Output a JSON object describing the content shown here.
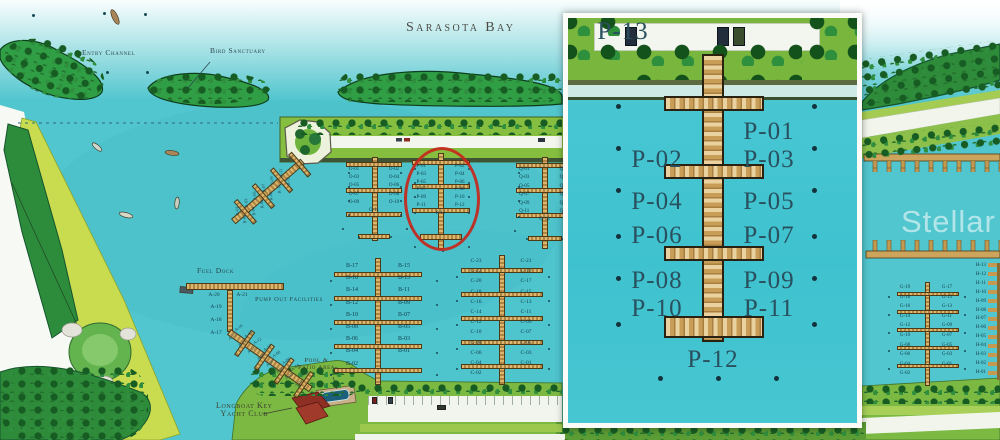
{
  "labels": {
    "bay": "Sarasota Bay",
    "entry_channel": "Entry Channel",
    "bird_sanctuary": "Bird Sanctuary",
    "fuel_dock": "Fuel Dock",
    "pump_out": "Pump Out Facilities",
    "pool_line1": "Pool &",
    "pool_line2": "Patio Area",
    "club_line1": "Longboat Key",
    "club_line2": "Yacht Club",
    "watermark": "Stellar MLS"
  },
  "docks": {
    "o": [
      "O-01",
      "O-02",
      "O-03",
      "O-04",
      "O-05",
      "O-06",
      "O-07",
      "O-08",
      "O-09",
      "O-10",
      "O-11"
    ],
    "p_main": [
      "P-01",
      "P-02",
      "P-03",
      "P-04",
      "P-05",
      "P-06",
      "P-07",
      "P-08",
      "P-09",
      "P-10",
      "P-11",
      "P-12",
      "P-13"
    ],
    "q": [
      "Q-01",
      "Q-02",
      "Q-03",
      "Q-04",
      "Q-05",
      "Q-06",
      "Q-07",
      "Q-08",
      "Q-09",
      "Q-10",
      "Q-11",
      "Q-12",
      "Q-13"
    ],
    "b": [
      "B-17",
      "B-15",
      "B-16",
      "B-13",
      "B-14",
      "B-11",
      "B-12",
      "B-09",
      "B-10",
      "B-07",
      "B-08",
      "B-05",
      "B-06",
      "B-03",
      "B-04",
      "B-01",
      "B-02"
    ],
    "c": [
      "C-23",
      "C-21",
      "C-22",
      "C-19",
      "C-20",
      "C-17",
      "C-18",
      "C-15",
      "C-16",
      "C-13",
      "C-14",
      "C-11",
      "C-12",
      "C-09",
      "C-10",
      "C-07",
      "C-08",
      "C-05",
      "C-06",
      "C-03",
      "C-04",
      "C-01",
      "C-02"
    ],
    "g": [
      "G-19",
      "G-17",
      "G-18",
      "G-15",
      "G-16",
      "G-13",
      "G-14",
      "G-11",
      "G-12",
      "G-09",
      "G-10",
      "G-07",
      "G-08",
      "G-05",
      "G-06",
      "G-03",
      "G-04",
      "G-01",
      "G-02"
    ],
    "h": [
      "H-13",
      "H-12",
      "H-11",
      "H-10",
      "H-09",
      "H-08",
      "H-07",
      "H-06",
      "H-05",
      "H-04",
      "H-03",
      "H-02",
      "H-01"
    ],
    "a_pair": [
      "A-20",
      "A-21"
    ],
    "a_col": [
      "A-19",
      "A-18",
      "A-17"
    ],
    "a_diag": [
      "A-16",
      "A-15",
      "A-14",
      "A-13",
      "A-12",
      "A-11",
      "A-10",
      "A-09",
      "A-08",
      "A-07",
      "A-06",
      "A-05",
      "A-04",
      "A-03",
      "A-02",
      "A-01"
    ],
    "r_diag": [
      "R-01",
      "R-02",
      "R-03",
      "R-04",
      "R-05",
      "R-06",
      "R-07",
      "R-08",
      "R-09",
      "R-10",
      "R-11",
      "R-12"
    ],
    "p_inset": [
      "P-01",
      "P-02",
      "P-03",
      "P-04",
      "P-05",
      "P-06",
      "P-07",
      "P-08",
      "P-09",
      "P-10",
      "P-11",
      "P-12",
      "P-13"
    ]
  },
  "colors": {
    "water": "#52c6ce",
    "land_green": "#7cb942",
    "dock_tan": "#c8a35a",
    "highlight_circle": "#c5271b",
    "label_ink": "#17424e"
  }
}
